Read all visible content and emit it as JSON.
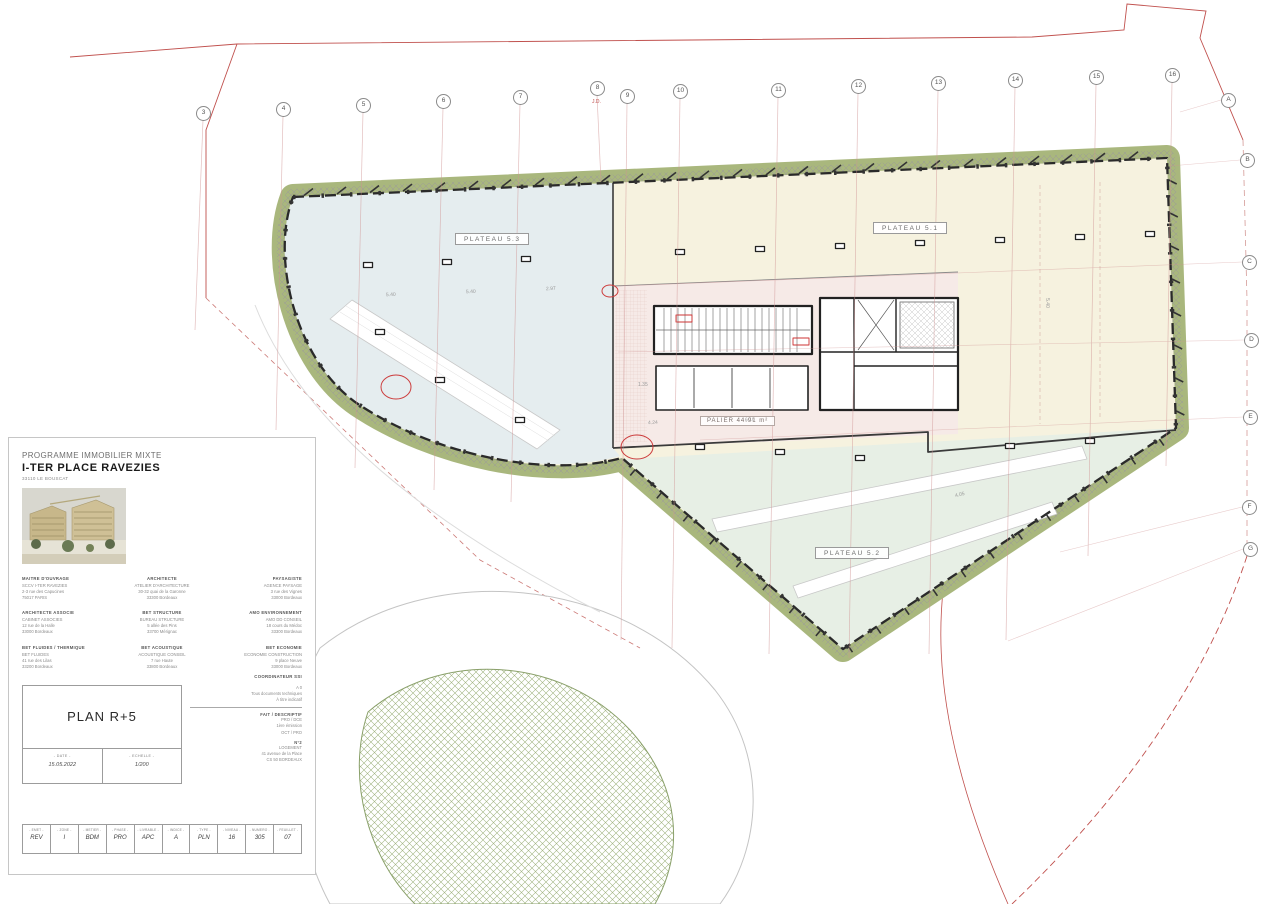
{
  "document": {
    "type_label": "PROGRAMME IMMOBILIER MIXTE",
    "project_name": "I-TER PLACE RAVEZIES",
    "project_location": "33110 LE BOUSCAT"
  },
  "plan": {
    "labels": {
      "plateau_51": "PLATEAU 5.1",
      "plateau_52": "PLATEAU 5.2",
      "plateau_53": "PLATEAU 5.3",
      "palier": "PALIER 44.91 m²",
      "annotation_jd": "J.D."
    },
    "grid": {
      "top_numbers": [
        "3",
        "4",
        "5",
        "6",
        "7",
        "8",
        "9",
        "10",
        "11",
        "12",
        "13",
        "14",
        "15",
        "16"
      ],
      "right_letters": [
        "A",
        "B",
        "C",
        "D",
        "E",
        "F",
        "G"
      ]
    },
    "dimensions": [
      "5.40",
      "5.40",
      "2.97",
      "4.24",
      "6.10",
      "4.05",
      "5.40",
      "1.35"
    ]
  },
  "title_block": {
    "drawing_title": "PLAN R+5",
    "date_label": "- DATE -",
    "date_value": "15.05.2022",
    "scale_label": "- ECHELLE -",
    "scale_value": "1/200",
    "parties": [
      {
        "role": "MAITRE D'OUVRAGE",
        "lines": [
          "SCCV I-TER RAVEZIES",
          "2-3 rue des Capucines",
          "75017 PARIS"
        ]
      },
      {
        "role": "ARCHITECTE",
        "lines": [
          "ATELIER D'ARCHITECTURE",
          "30-32 quai de la Garonne",
          "33300 Bordeaux"
        ]
      },
      {
        "role": "PAYSAGISTE",
        "lines": [
          "AGENCE PAYSAGE",
          "3 rue des Vignes",
          "33000 Bordeaux"
        ]
      },
      {
        "role": "ARCHITECTE ASSOCIE",
        "lines": [
          "CABINET ASSOCIES",
          "12 rue de la Halle",
          "33000 Bordeaux"
        ]
      },
      {
        "role": "BET STRUCTURE",
        "lines": [
          "BUREAU STRUCTURE",
          "5 allée des Pins",
          "33700 Mérignac"
        ]
      },
      {
        "role": "AMO ENVIRONNEMENT",
        "lines": [
          "AMO DD CONSEIL",
          "18 cours du Médoc",
          "33300 Bordeaux"
        ]
      },
      {
        "role": "BET FLUIDES / THERMIQUE",
        "lines": [
          "BET FLUIDES",
          "41 rue des Lilas",
          "33200 Bordeaux"
        ]
      },
      {
        "role": "BET ACOUSTIQUE",
        "lines": [
          "ACOUSTIQUE CONSEIL",
          "7 rue Haute",
          "33800 Bordeaux"
        ]
      },
      {
        "role": "BET ECONOMIE",
        "lines": [
          "ECONOMIE CONSTRUCTION",
          "9 place Neuve",
          "33000 Bordeaux"
        ]
      }
    ],
    "ssi_label": "COORDINATEUR SSI",
    "notes": [
      "A 0",
      "Tous documents techniques",
      "À titre indicatif"
    ],
    "descriptif_label": "FAIT / DESCRIPTIF",
    "descriptif_lines": [
      "PRO / DCE",
      "1ère émission",
      "OCT / PRO"
    ],
    "sheet_note": "N°2",
    "client_lines": [
      "LOGEMENT",
      "41 avenue de la Place",
      "CS 50 BORDEAUX"
    ],
    "code_strip": {
      "headers": [
        "- EMET -",
        "- ZONE -",
        "- METIER -",
        "- PHASE -",
        "- LIVRABLE -",
        "- INDICE -",
        "- TYPE -",
        "- NIVEAU -",
        "- NUMERO -",
        "- FEUILLET -"
      ],
      "values": [
        "REV",
        "I",
        "BDM",
        "PRO",
        "APC",
        "A",
        "PLN",
        "16",
        "305",
        "07"
      ]
    }
  }
}
